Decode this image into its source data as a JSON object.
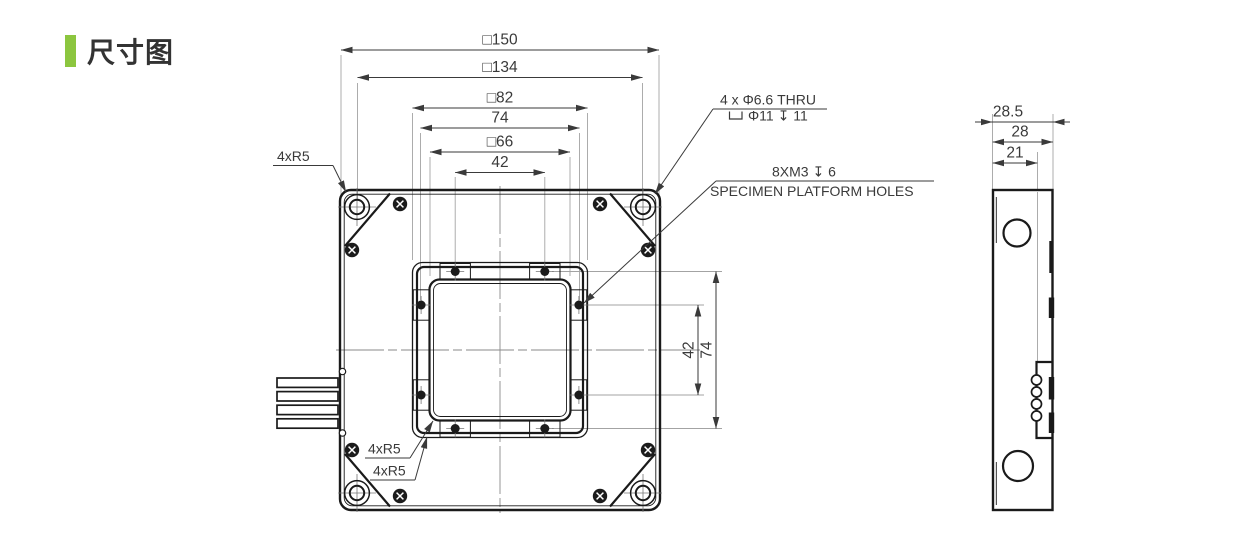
{
  "header": {
    "title": "尺寸图",
    "accent_color": "#8CC63F"
  },
  "front_view": {
    "horizontal_dims": {
      "outer_square": "□150",
      "corner_hole_spacing": "□134",
      "platform_square": "□82",
      "hole_span": "74",
      "aperture_square": "□66",
      "hole_pitch": "42"
    },
    "vertical_dims": {
      "hole_pitch": "42",
      "hole_span": "74"
    },
    "callouts": {
      "corner_radius": "4xR5",
      "aperture_radius": "4xR5",
      "platform_radius": "4xR5",
      "corner_holes_spec": "4 x Φ6.6 THRU",
      "counterbore_symbol": "⌴",
      "counterbore_spec": "Φ11 ↧ 11",
      "platform_holes_spec": "8XM3 ↧ 6",
      "platform_holes_label": "SPECIMEN PLATFORM HOLES"
    }
  },
  "side_view": {
    "dims": {
      "overall_width": "28.5",
      "body_width": "28",
      "inner_width": "21"
    }
  }
}
